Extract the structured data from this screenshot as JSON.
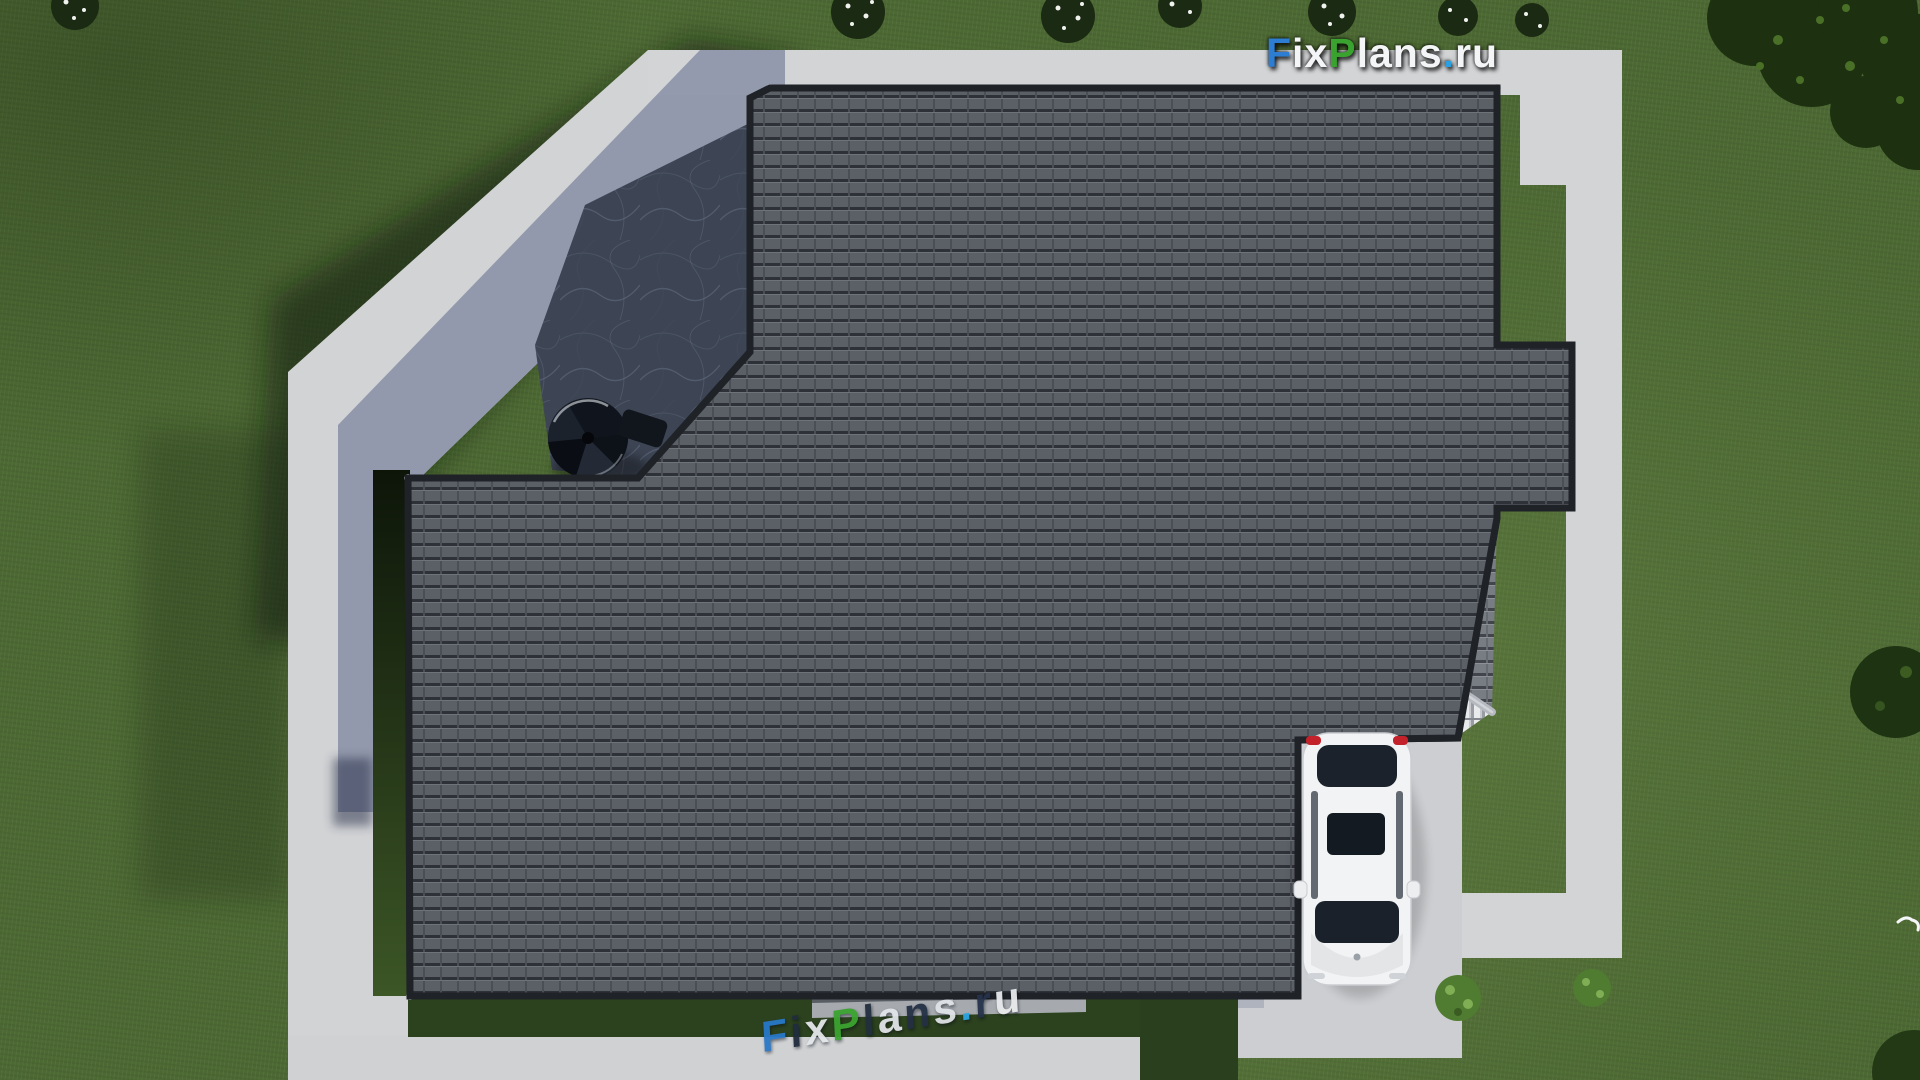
{
  "watermark_top": {
    "full": "FixPlans.ru",
    "f": "F",
    "ix": "ix",
    "p": "P",
    "lans": "lans",
    "dot": ".",
    "ru": "ru"
  },
  "watermark_bottom": {
    "full": "FixPlans.ru",
    "chars": [
      "F",
      "i",
      "x",
      "P",
      "l",
      "a",
      "n",
      "s",
      ".",
      "r",
      "u"
    ]
  },
  "colors": {
    "logo_blue": "#2d7dd2",
    "logo_green": "#3aa32f",
    "logo_white": "#f4f5f6",
    "logo_dot_blue": "#2aa0e0",
    "lawn": "#4d6933",
    "lawn_shadow": "#16230f",
    "pavement": "#d2d3d5",
    "pavement_shadow": "#7e88a6",
    "roof_dark_tile": "#5b5f66",
    "roof_medium_tile": "#787c83",
    "roof_sunlit_tile": "#e9eaec",
    "ridge_cap": "#b6bac0",
    "slate_patio": "#474e5b",
    "car_body": "#f2f3f4",
    "car_glass": "#1a212b",
    "taillight_red": "#c3222a"
  },
  "objects": {
    "scene": "top-down 3d render of house hip roof with yard",
    "house_roof": "dark tiled hip roof complex",
    "porch": "gabled entrance porch roof",
    "chimneys": "two chimneys with hip caps",
    "snow_guards": "snow guard bars on roof slopes",
    "stone_patio": "dark stone patio with spiral staircase",
    "paths": "concrete walkways surrounding house",
    "driveway": "concrete driveway with parked white sedan",
    "greenery": "lawn, flowering bushes and trees"
  }
}
